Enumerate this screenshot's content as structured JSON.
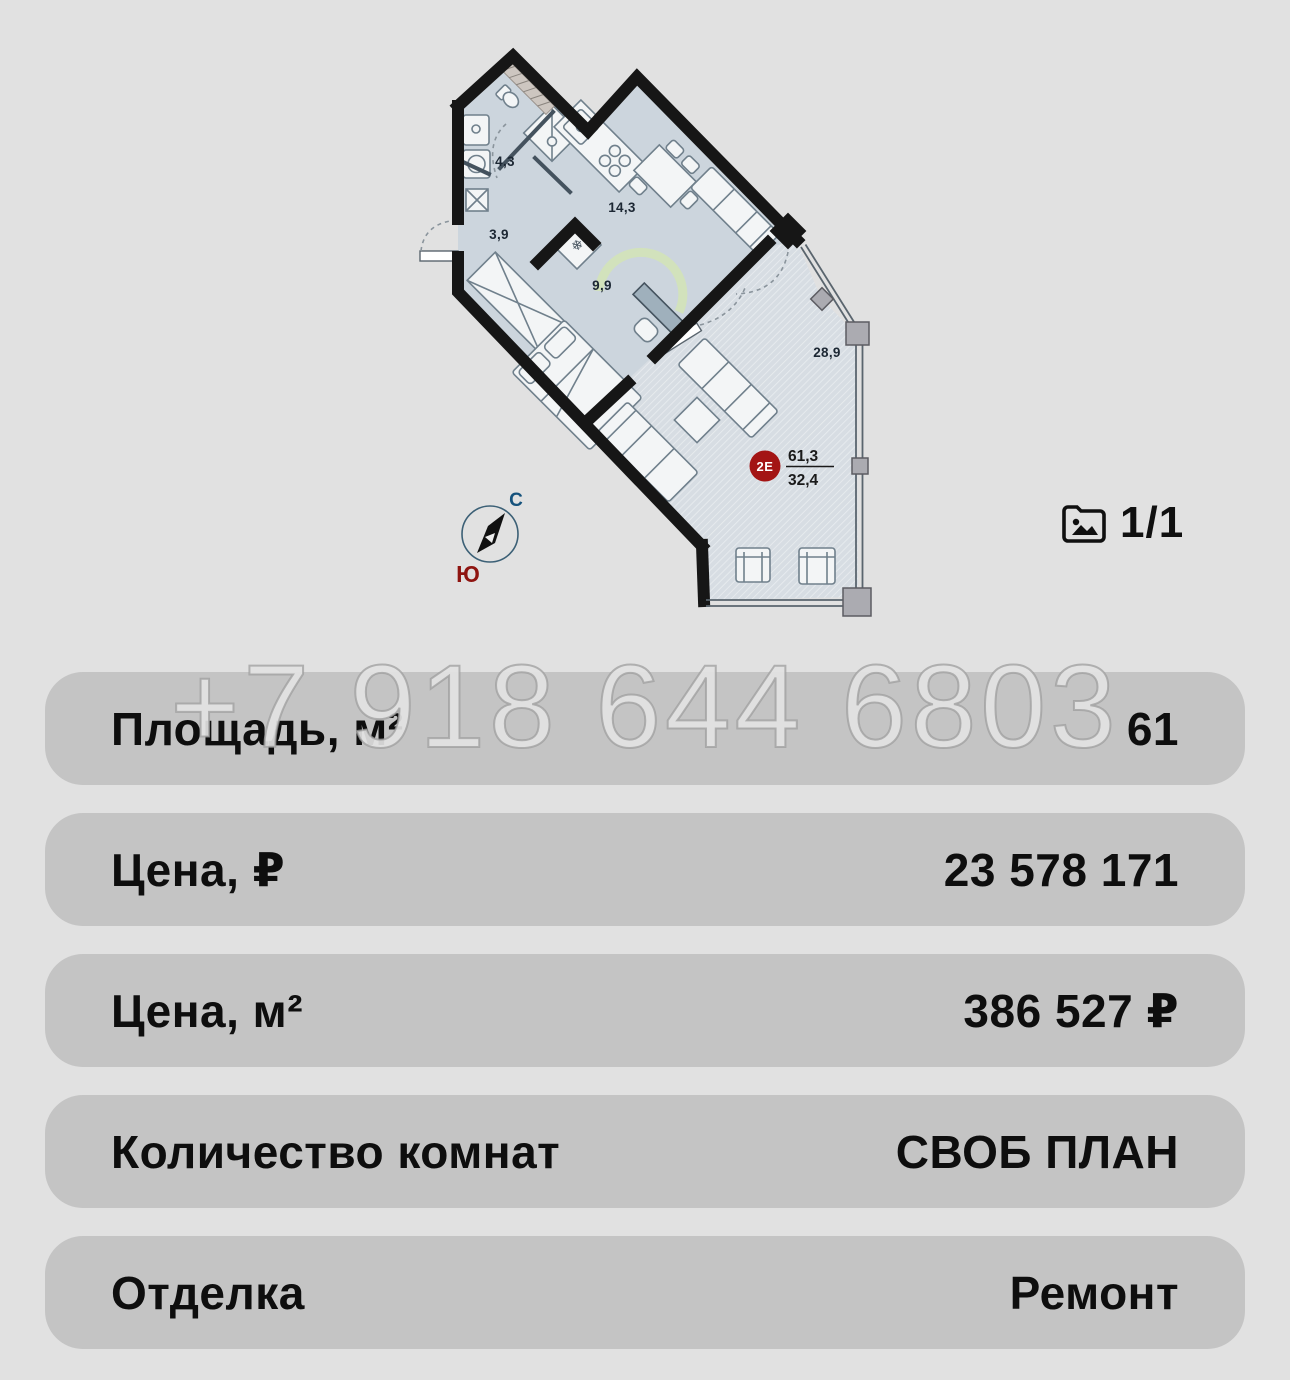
{
  "page": {
    "background": "#e1e1e1",
    "row_background": "#c4c4c4"
  },
  "watermark": {
    "text": "+7 918 644 6803"
  },
  "gallery": {
    "counter": "1/1",
    "icon": "photo-folder-icon"
  },
  "plan": {
    "rooms": [
      {
        "name": "bathroom",
        "area": "4,3"
      },
      {
        "name": "hallway",
        "area": "3,9"
      },
      {
        "name": "kitchen-dining",
        "area": "14,3"
      },
      {
        "name": "bedroom",
        "area": "9,9"
      },
      {
        "name": "living-room",
        "area": "28,9"
      }
    ],
    "badge": {
      "label": "2Е",
      "total_area": "61,3",
      "living_area": "32,4",
      "color": "#a31414"
    },
    "compass": {
      "north": "С",
      "south": "Ю",
      "north_color": "#15527c",
      "south_color": "#8e1410"
    }
  },
  "rows": [
    {
      "label": "Площадь, м²",
      "value": "61"
    },
    {
      "label": "Цена, ₽",
      "value": "23 578 171"
    },
    {
      "label": "Цена, м²",
      "value": "386 527 ₽"
    },
    {
      "label": "Количество комнат",
      "value": "СВОБ ПЛАН"
    },
    {
      "label": "Отделка",
      "value": "Ремонт"
    }
  ]
}
